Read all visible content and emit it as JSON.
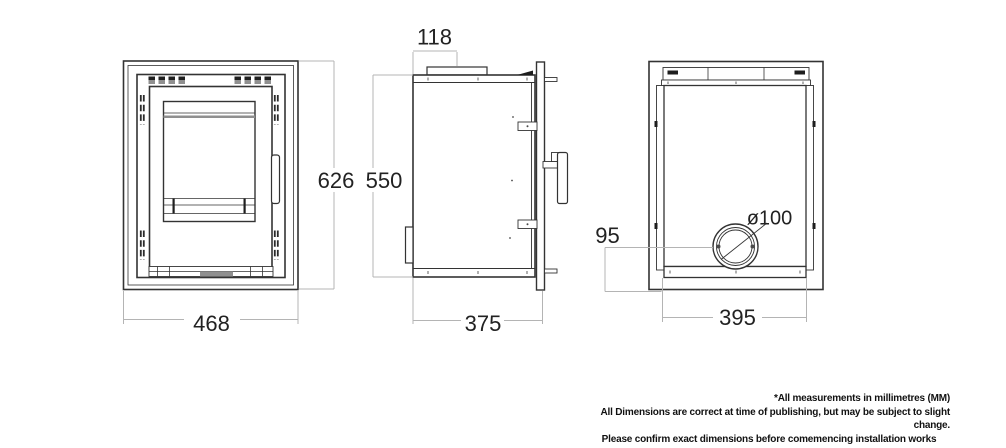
{
  "dimensions": {
    "front_width": "468",
    "front_height": "626",
    "flue_offset_from_back": "118",
    "body_height": "550",
    "depth": "375",
    "flue_center_from_bottom": "95",
    "flue_diameter": "ø100",
    "rear_width": "395"
  },
  "footnote": {
    "line1": "*All measurements in millimetres (MM)",
    "line2": "All Dimensions are correct at time of publishing, but may be subject to slight change.",
    "line3": "Please confirm exact dimensions before comemencing installation works"
  },
  "colors": {
    "background": "#ffffff",
    "line_dark": "#333333",
    "line_dimension": "#b4b4b4",
    "fill_dark": "#1e1e1e",
    "fill_gray": "#8f8f8f",
    "text": "#222222",
    "footnote_text": "#111111"
  }
}
